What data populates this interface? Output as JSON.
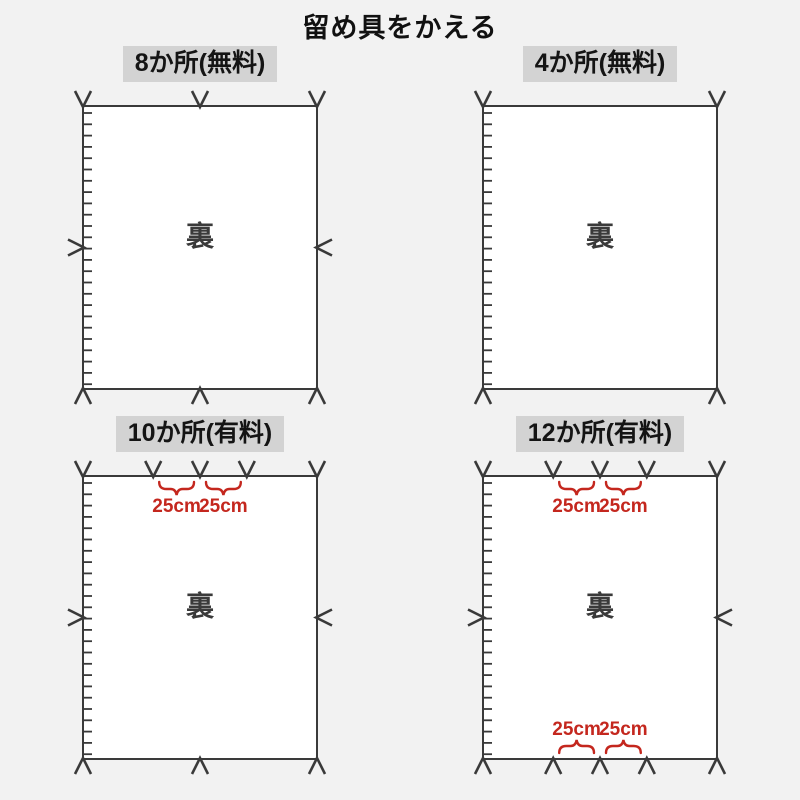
{
  "page": {
    "title": "留め具をかえる"
  },
  "colors": {
    "background": "#f2f2f2",
    "header_bg": "#d3d3d3",
    "line": "#3a3a3a",
    "fabric_fill": "#ffffff",
    "measure": "#c4271e"
  },
  "back_label": "裏",
  "panels": [
    {
      "header": "8か所(無料)",
      "price_type": "free",
      "count": 8,
      "top_arrows": [
        0,
        0.5,
        1
      ],
      "bottom_arrows": [
        0,
        0.5,
        1
      ],
      "side_arrows": true,
      "top_braces": [],
      "bottom_braces": []
    },
    {
      "header": "4か所(無料)",
      "price_type": "free",
      "count": 4,
      "top_arrows": [
        0,
        1
      ],
      "bottom_arrows": [
        0,
        1
      ],
      "side_arrows": false,
      "top_braces": [],
      "bottom_braces": []
    },
    {
      "header": "10か所(有料)",
      "price_type": "paid",
      "count": 10,
      "top_arrows": [
        0,
        0.3,
        0.5,
        0.7,
        1
      ],
      "bottom_arrows": [
        0,
        0.5,
        1
      ],
      "side_arrows": true,
      "top_braces": [
        {
          "from": 0.3,
          "to": 0.5,
          "label": "25cm"
        },
        {
          "from": 0.5,
          "to": 0.7,
          "label": "25cm"
        }
      ],
      "bottom_braces": []
    },
    {
      "header": "12か所(有料)",
      "price_type": "paid",
      "count": 12,
      "top_arrows": [
        0,
        0.3,
        0.5,
        0.7,
        1
      ],
      "bottom_arrows": [
        0,
        0.3,
        0.5,
        0.7,
        1
      ],
      "side_arrows": true,
      "top_braces": [
        {
          "from": 0.3,
          "to": 0.5,
          "label": "25cm"
        },
        {
          "from": 0.5,
          "to": 0.7,
          "label": "25cm"
        }
      ],
      "bottom_braces": [
        {
          "from": 0.3,
          "to": 0.5,
          "label": "25cm"
        },
        {
          "from": 0.5,
          "to": 0.7,
          "label": "25cm"
        }
      ]
    }
  ]
}
